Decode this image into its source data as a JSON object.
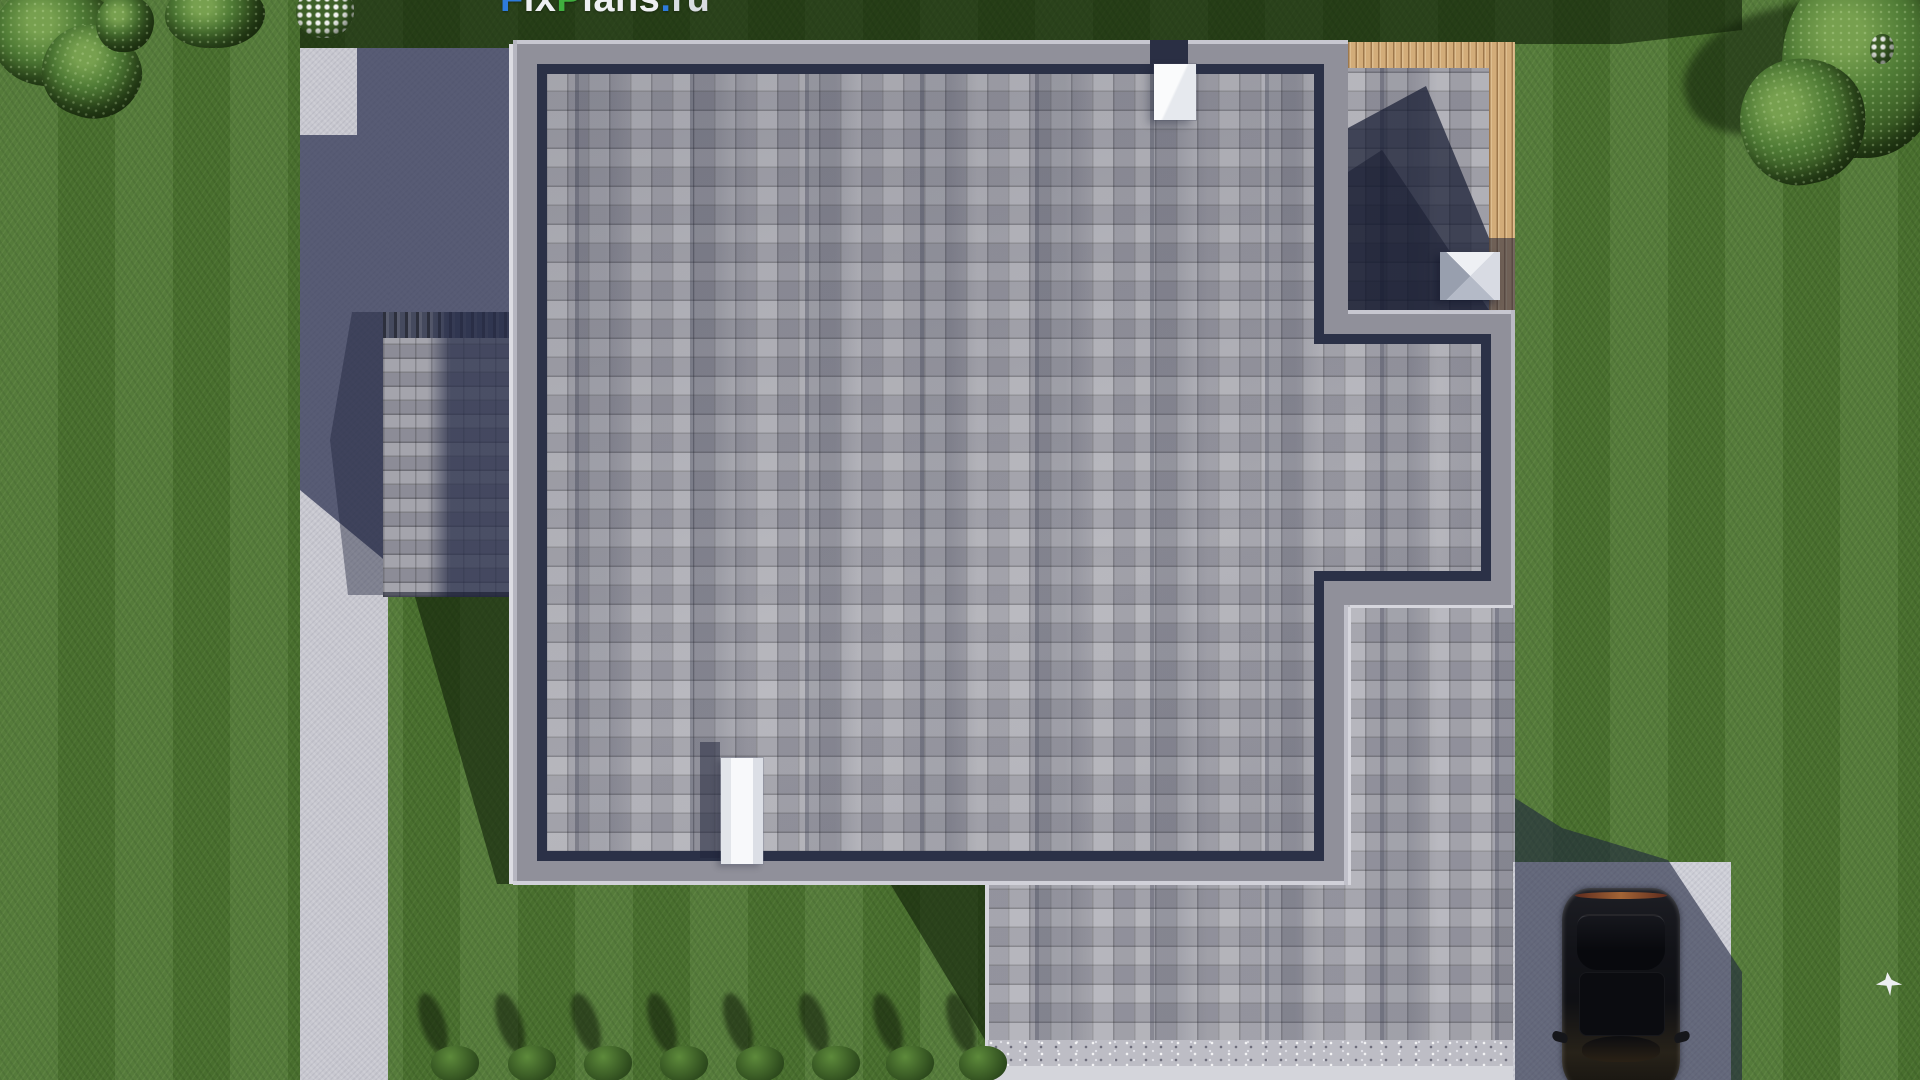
{
  "watermark": {
    "segments": [
      {
        "text": "F",
        "role": "blue"
      },
      {
        "text": "ix",
        "role": "white"
      },
      {
        "text": "P",
        "role": "green"
      },
      {
        "text": "lans",
        "role": "white"
      },
      {
        "text": ".",
        "role": "blue"
      },
      {
        "text": "ru",
        "role": "muted"
      }
    ],
    "colors": {
      "blue": "#2e7bdc",
      "green": "#3fae3e",
      "white": "#eef0f3",
      "muted": "#d9dde2"
    }
  },
  "scene": {
    "description": "Aerial top-down 3D render of a single-family house: gray square-shingle flat roof with parapet, rooftop terrace edged with wooden decking, white chimney and two white skylights, attached lower garage wing, L-shaped light concrete walkway on the left, driveway pad with a black car at bottom right, mowed lawn with bushes, white flowers and a white dove.",
    "palette": {
      "grass": "#4c7430",
      "grass_shadow": "#101e08",
      "concrete": "#c8c8d0",
      "concrete_shadow": "#2f3553",
      "parapet_gray": "#90909a",
      "roof_shingle": "#a6a6ae",
      "roof_inner_shadow": "#2b3147",
      "terrace_wood": "#d2ac79",
      "skylight_white": "#f4f5f7",
      "car_body": "#121317",
      "driveway": "#cdced6"
    },
    "bottom_bushes_x": [
      455,
      532,
      608,
      684,
      760,
      836,
      910,
      983
    ]
  }
}
